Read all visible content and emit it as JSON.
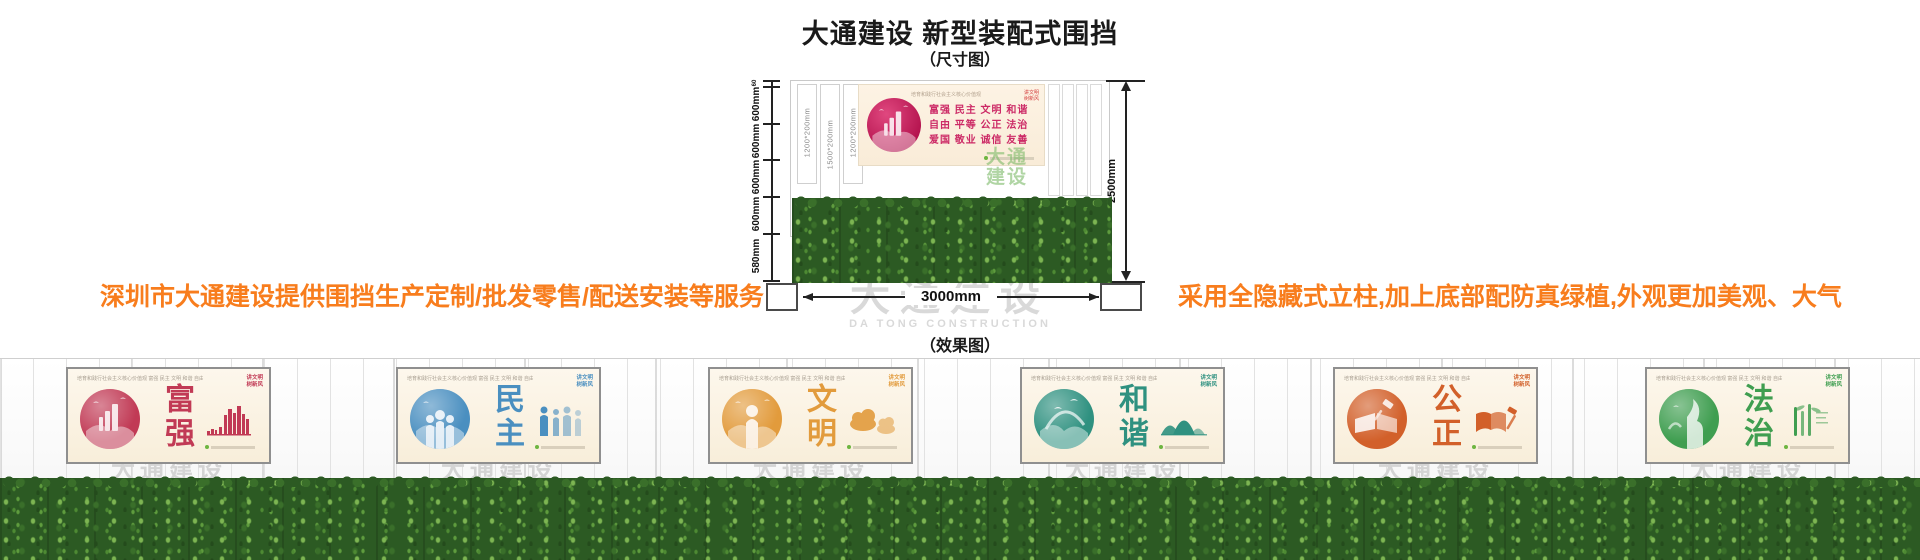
{
  "header": {
    "title": "大通建设 新型装配式围挡",
    "dimension_caption": "（尺寸图）",
    "effect_caption": "（效果图）"
  },
  "notes": {
    "left": "深圳市大通建设提供围挡生产定制/批发零售/配送安装等服务",
    "right": "采用全隐藏式立柱,加上底部配防真绿植,外观更加美观、大气",
    "color": "#f87d1d"
  },
  "dimension_diagram": {
    "left_dims": [
      "60",
      "600mm",
      "600mm",
      "600mm",
      "600mm",
      "580mm"
    ],
    "right_dim": "2500mm",
    "bottom_dim": "3000mm",
    "slat_labels": [
      "1200*200mm",
      "1500*200mm",
      "1200*200mm"
    ],
    "banner": {
      "header": "培育和践行社会主义核心价值观",
      "corner_line1": "讲文明",
      "corner_line2": "树新风",
      "rows": [
        "富强 民主 文明 和谐",
        "自由 平等 公正 法治",
        "爱国 敬业 诚信 友善"
      ],
      "text_color": "#cc2a66",
      "circle_color": "#b3124d"
    },
    "logo_watermark_line1": "大通",
    "logo_watermark_line2": "建设",
    "logo_watermark_color": "#7cb968"
  },
  "watermark": {
    "cn": "大通建设",
    "en": "DA TONG CONSTRUCTION"
  },
  "panel_common": {
    "header": "培育和践行社会主义核心价值观  富强 民主 文明 和谐 自由 平等 公正 法治 爱国 敬业 诚信 友善",
    "corner_line1": "讲文明",
    "corner_line2": "树新风"
  },
  "effect_panels": [
    {
      "word": "富强",
      "color": "#c13a55",
      "icon": "city-skyline-icon"
    },
    {
      "word": "民主",
      "color": "#4a8fc0",
      "icon": "people-hands-icon"
    },
    {
      "word": "文明",
      "color": "#e29b3c",
      "icon": "clouds-icon"
    },
    {
      "word": "和谐",
      "color": "#2f9180",
      "icon": "mountains-icon"
    },
    {
      "word": "公正",
      "color": "#d2602a",
      "icon": "book-gavel-icon"
    },
    {
      "word": "法治",
      "color": "#3f9e50",
      "icon": "bamboo-icon"
    }
  ],
  "hedge_color": "#2c5a23"
}
